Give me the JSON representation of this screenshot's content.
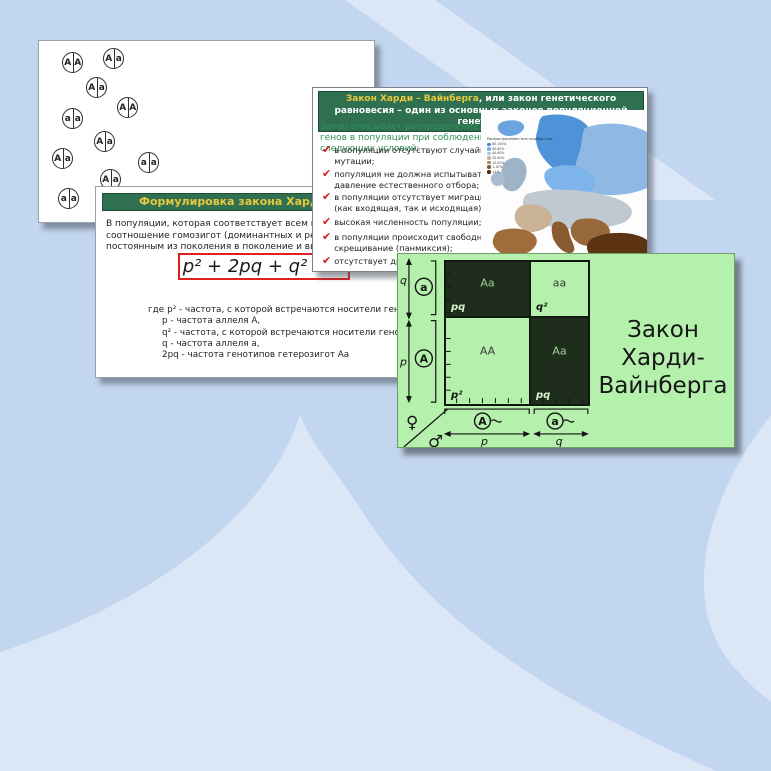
{
  "colors": {
    "background_base": "#c2d6ef",
    "background_light": "#dbe7f7",
    "header_green": "#2e7050",
    "header_yellow": "#e9c73f",
    "check_red": "#cf1f1f",
    "formula_border_red": "#e02020",
    "square_slide_green": "#b5f1ad",
    "square_dark_cell": "#1f2e1c"
  },
  "slide_population": {
    "circles": [
      {
        "left": "A",
        "right": "A",
        "x": 23,
        "y": 11
      },
      {
        "left": "A",
        "right": "a",
        "x": 64,
        "y": 7
      },
      {
        "left": "A",
        "right": "a",
        "x": 47,
        "y": 36
      },
      {
        "left": "A",
        "right": "A",
        "x": 78,
        "y": 56
      },
      {
        "left": "a",
        "right": "a",
        "x": 23,
        "y": 67
      },
      {
        "left": "A",
        "right": "a",
        "x": 55,
        "y": 90
      },
      {
        "left": "A",
        "right": "a",
        "x": 13,
        "y": 107
      },
      {
        "left": "a",
        "right": "a",
        "x": 99,
        "y": 111
      },
      {
        "left": "A",
        "right": "a",
        "x": 61,
        "y": 128
      },
      {
        "left": "a",
        "right": "a",
        "x": 19,
        "y": 147
      }
    ]
  },
  "slide_formulation": {
    "title": "Формулировка закона Харди – Вайнберга",
    "body_lines": [
      "В популяции, которая соответствует всем вышеперечисленным условиям,",
      "соотношение гомозигот (доминантных и рецессивных) и гетерозигот остается",
      "постоянным из поколения в поколение и выражается формулой:"
    ],
    "formula": "p² + 2pq + q² = 1",
    "where_label": "где",
    "definitions": [
      "p² - частота, с которой встречаются носители генотипа  АА,",
      "p - частота аллеля А,",
      "q² - частота, с которой встречаются носители генотипа аа,",
      "q - частота аллеля а,",
      "2pq - частота генотипов гетерозигот Аа"
    ]
  },
  "slide_law": {
    "title_highlight": "Закон Харди – Вайнберга",
    "title_rest": ", или закон генетического равновесия – один из основных законов популяционной генетики",
    "intro": "Закон описывает распределение генов в популяции при соблюдении следующих условий:",
    "conditions": [
      {
        "text": "в популяции отсутствуют случайные мутации;",
        "top": 57
      },
      {
        "text": "популяция не должна испытывать давление естественного отбора;",
        "top": 81
      },
      {
        "text": "в популяции отсутствует миграция (как входящая, так и исходящая);",
        "top": 104
      },
      {
        "text": "высокая численность популяции;",
        "top": 129
      },
      {
        "text": "в популяции происходит свободное скрещивание (панмиксия);",
        "top": 144
      },
      {
        "text": "отсутствует дрейф генов",
        "top": 168
      }
    ],
    "map": {
      "legend_title": "Распространение гена голубых глаз",
      "legend": [
        {
          "color": "#3f86cf",
          "label": "80-100%"
        },
        {
          "color": "#77aee3",
          "label": "60-80%"
        },
        {
          "color": "#aac4dd",
          "label": "40-60%"
        },
        {
          "color": "#c2b49a",
          "label": "20-40%"
        },
        {
          "color": "#a8845c",
          "label": "10-20%"
        },
        {
          "color": "#7d5836",
          "label": "1-10%"
        },
        {
          "color": "#4f2e12",
          "label": "<1%"
        }
      ]
    }
  },
  "slide_square": {
    "title_line1": "Закон Харди-",
    "title_line2": "Вайнберга",
    "quadrants": [
      {
        "genotype": "Aa",
        "freq": "pq",
        "dark": true,
        "classes": "br bb"
      },
      {
        "genotype": "aa",
        "freq": "q²",
        "dark": false,
        "classes": "bb"
      },
      {
        "genotype": "AA",
        "freq": "p²",
        "dark": false,
        "classes": "br"
      },
      {
        "genotype": "Aa",
        "freq": "pq",
        "dark": true,
        "classes": ""
      }
    ],
    "axis": {
      "q_label": "q",
      "p_label": "p",
      "allele_a": "a",
      "allele_A": "A",
      "bottom_allele_A": "A",
      "bottom_allele_a": "a",
      "bottom_p": "p",
      "bottom_q": "q",
      "female": "♀",
      "male": "♂"
    }
  }
}
